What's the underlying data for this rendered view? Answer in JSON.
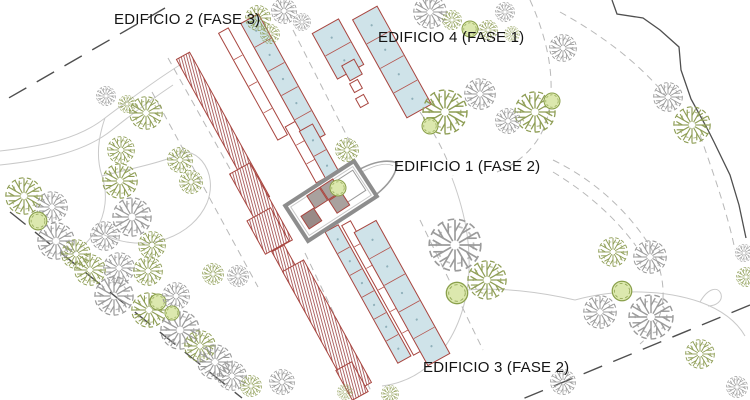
{
  "labels": {
    "edificio2": "EDIFICIO 2 (FASE 3)",
    "edificio4": "EDIFICIO 4 (FASE 1)",
    "edificio1": "EDIFICIO 1 (FASE 2)",
    "edificio3": "EDIFICIO 3 (FASE 2)"
  },
  "colors": {
    "pool_fill": "#cfe3e9",
    "building_stroke": "#a8453f",
    "hatch": "#a35050",
    "division": "#b5554e",
    "dot": "#8fb0ba",
    "wall_gray": "#8d8d8d",
    "inner_gray": "#c9c9c9",
    "road": "#c9c9c9",
    "road_dashed": "#b8b8b8",
    "boundary": "#4f4f4f",
    "tree_olive": "#8f9e56",
    "tree_gray": "#9b9b9b",
    "bush_fill": "#dce8ae",
    "bush_stroke": "#8aa04c",
    "label": "#141414"
  },
  "site": {
    "boundary": {
      "dashed": [
        [
          [
            165,
            8
          ],
          [
            0,
            103
          ]
        ],
        [
          [
            10,
            212
          ],
          [
            242,
            398
          ]
        ],
        [
          [
            750,
            305
          ],
          [
            520,
            400
          ]
        ]
      ],
      "solid": [
        [
          [
            612,
            0
          ],
          [
            617,
            14
          ],
          [
            643,
            18
          ],
          [
            660,
            30
          ],
          [
            679,
            47
          ],
          [
            681,
            70
          ],
          [
            691,
            99
          ],
          [
            708,
            130
          ],
          [
            714,
            142
          ],
          [
            730,
            175
          ],
          [
            739,
            205
          ],
          [
            746,
            238
          ]
        ]
      ]
    },
    "roads": {
      "solid": [
        "M0,151 C45,146 80,138 105,118 C125,103 145,88 166,74",
        "M0,165 C48,160 86,151 112,130 C132,114 152,99 173,85",
        "M105,118 C98,138 96,158 102,176 C108,194 106,214 96,230 C90,240 82,248 72,254",
        "M102,176 C125,170 152,165 176,156",
        "M96,230 C115,243 142,247 166,239 C186,232 200,219 207,203 C213,188 211,172 202,161 C194,152 184,149 176,156",
        "M166,74 C175,68 184,62 193,57",
        "M452,178 C466,215 473,252 467,290 C462,322 448,348 428,366 C414,378 398,384 382,386",
        "M467,290 C500,287 540,292 575,300",
        "M575,300 C620,288 665,290 700,302 C722,310 737,322 745,336",
        "M700,302 C708,288 718,286 721,294 C723,301 716,306 708,306"
      ],
      "dashed": [
        "M168,58 L282,262",
        "M152,92 L258,287",
        "M293,30 L352,146",
        "M305,253 L371,391",
        "M420,220 L483,350",
        "M530,0 C548,40 556,80 548,115 C542,142 522,162 497,172",
        "M553,160 C590,178 622,205 646,240 C658,258 664,278 663,298",
        "M560,12 C600,34 638,62 666,96",
        "M663,298 C662,316 654,332 640,344",
        "M420,112 C436,135 447,157 453,176",
        "M553,172 C586,192 614,216 636,246",
        "M700,135 C714,175 728,215 735,250"
      ]
    },
    "buildings": [
      {
        "type": "hatch",
        "cx": 223,
        "cy": 128,
        "l": 165,
        "w": 15,
        "rot": -29
      },
      {
        "type": "hatch",
        "cx": 261,
        "cy": 207,
        "l": 88,
        "w": 23,
        "rot": -29
      },
      {
        "type": "outline",
        "cx": 253,
        "cy": 84,
        "l": 122,
        "w": 11,
        "rot": -29,
        "div": 4
      },
      {
        "type": "outline",
        "cx": 306,
        "cy": 152,
        "l": 64,
        "w": 12,
        "rot": -29,
        "div": 3
      },
      {
        "type": "pool",
        "cx": 283,
        "cy": 79,
        "l": 138,
        "w": 20,
        "rot": -29,
        "div": 5
      },
      {
        "type": "pool",
        "cx": 320,
        "cy": 153,
        "l": 58,
        "w": 15,
        "rot": -29,
        "div": 2
      },
      {
        "type": "pool",
        "cx": 338,
        "cy": 49,
        "l": 52,
        "w": 30,
        "rot": -29,
        "div": 2
      },
      {
        "type": "pool",
        "cx": 352,
        "cy": 70,
        "l": 17,
        "w": 14,
        "rot": -29
      },
      {
        "type": "outline",
        "cx": 356,
        "cy": 86,
        "l": 10,
        "w": 9,
        "rot": -29
      },
      {
        "type": "outline",
        "cx": 362,
        "cy": 101,
        "l": 10,
        "w": 9,
        "rot": -29
      },
      {
        "type": "pool",
        "cx": 392,
        "cy": 62,
        "l": 112,
        "w": 28,
        "rot": -29,
        "div": 4
      },
      {
        "type": "hatch",
        "cx": 291,
        "cy": 272,
        "l": 54,
        "w": 14,
        "rot": -29
      },
      {
        "type": "hatch",
        "cx": 327,
        "cy": 327,
        "l": 140,
        "w": 24,
        "rot": -29
      },
      {
        "type": "pool",
        "cx": 368,
        "cy": 294,
        "l": 150,
        "w": 15,
        "rot": -29,
        "div": 6
      },
      {
        "type": "outline",
        "cx": 382,
        "cy": 288,
        "l": 148,
        "w": 10,
        "rot": -29,
        "div": 6
      },
      {
        "type": "pool",
        "cx": 402,
        "cy": 293,
        "l": 152,
        "w": 25,
        "rot": -29,
        "div": 5
      },
      {
        "type": "hatch",
        "cx": 352,
        "cy": 381,
        "l": 34,
        "w": 18,
        "rot": -29
      },
      {
        "type": "hatch",
        "cx": 268,
        "cy": 231,
        "l": 38,
        "w": 27,
        "rot": -29
      }
    ],
    "plaza": {
      "boat": {
        "cx": 357,
        "cy": 189,
        "len": 96,
        "wid": 31,
        "rot": -33
      },
      "hall": {
        "cx": 331,
        "cy": 201,
        "len": 82,
        "wid": 42,
        "rot": -33
      },
      "cells": [
        {
          "dx": -10,
          "dy": -10,
          "s": 15,
          "fill": "#a9a19e"
        },
        {
          "dx": 6,
          "dy": -10,
          "s": 15,
          "fill": "#a9a19e"
        },
        {
          "dx": 6,
          "dy": 6,
          "s": 15,
          "fill": "#a9a19e"
        },
        {
          "dx": -26,
          "dy": 4,
          "s": 15,
          "fill": "#998a87"
        }
      ],
      "court": {
        "dx": 23,
        "dy": -2,
        "s": 24
      }
    },
    "trees": [
      [
        258,
        18,
        13,
        "o"
      ],
      [
        284,
        11,
        13,
        "g"
      ],
      [
        270,
        34,
        10,
        "o"
      ],
      [
        302,
        22,
        9,
        "g"
      ],
      [
        430,
        12,
        17,
        "g"
      ],
      [
        452,
        20,
        10,
        "o"
      ],
      [
        470,
        29,
        9,
        "b"
      ],
      [
        488,
        30,
        10,
        "o"
      ],
      [
        505,
        12,
        10,
        "g"
      ],
      [
        512,
        34,
        8,
        "o"
      ],
      [
        563,
        48,
        14,
        "g"
      ],
      [
        668,
        97,
        15,
        "g"
      ],
      [
        692,
        125,
        19,
        "o"
      ],
      [
        106,
        96,
        10,
        "g"
      ],
      [
        127,
        104,
        9,
        "o"
      ],
      [
        146,
        113,
        17,
        "o"
      ],
      [
        121,
        150,
        14,
        "o"
      ],
      [
        180,
        160,
        13,
        "o"
      ],
      [
        191,
        182,
        12,
        "o"
      ],
      [
        24,
        196,
        19,
        "o"
      ],
      [
        52,
        207,
        16,
        "g"
      ],
      [
        38,
        221,
        10,
        "b"
      ],
      [
        56,
        241,
        19,
        "g"
      ],
      [
        76,
        254,
        15,
        "o"
      ],
      [
        120,
        181,
        18,
        "o"
      ],
      [
        132,
        217,
        20,
        "g"
      ],
      [
        105,
        236,
        15,
        "g"
      ],
      [
        152,
        245,
        14,
        "o"
      ],
      [
        347,
        150,
        12,
        "o"
      ],
      [
        338,
        188,
        9,
        "b"
      ],
      [
        445,
        112,
        23,
        "o"
      ],
      [
        480,
        94,
        16,
        "g"
      ],
      [
        535,
        112,
        21,
        "o"
      ],
      [
        552,
        101,
        9,
        "b"
      ],
      [
        430,
        126,
        9,
        "b"
      ],
      [
        508,
        121,
        13,
        "g"
      ],
      [
        613,
        252,
        15,
        "o"
      ],
      [
        650,
        257,
        17,
        "g"
      ],
      [
        622,
        291,
        11,
        "b"
      ],
      [
        600,
        312,
        17,
        "g"
      ],
      [
        651,
        317,
        23,
        "g"
      ],
      [
        563,
        382,
        13,
        "g"
      ],
      [
        744,
        253,
        9,
        "g"
      ],
      [
        746,
        277,
        10,
        "o"
      ],
      [
        455,
        245,
        27,
        "g"
      ],
      [
        487,
        280,
        20,
        "o"
      ],
      [
        457,
        293,
        12,
        "b"
      ],
      [
        90,
        270,
        16,
        "o"
      ],
      [
        119,
        268,
        16,
        "g"
      ],
      [
        148,
        271,
        15,
        "o"
      ],
      [
        114,
        296,
        20,
        "g"
      ],
      [
        149,
        310,
        18,
        "o"
      ],
      [
        158,
        302,
        9,
        "b"
      ],
      [
        180,
        330,
        20,
        "g"
      ],
      [
        200,
        346,
        16,
        "o"
      ],
      [
        215,
        362,
        18,
        "g"
      ],
      [
        176,
        296,
        14,
        "g"
      ],
      [
        232,
        376,
        15,
        "g"
      ],
      [
        251,
        386,
        11,
        "o"
      ],
      [
        213,
        274,
        11,
        "o"
      ],
      [
        238,
        276,
        11,
        "g"
      ],
      [
        172,
        313,
        8,
        "b"
      ],
      [
        282,
        382,
        13,
        "g"
      ],
      [
        390,
        394,
        9,
        "o"
      ],
      [
        345,
        392,
        8,
        "o"
      ],
      [
        700,
        354,
        15,
        "o"
      ],
      [
        737,
        387,
        11,
        "g"
      ]
    ]
  }
}
